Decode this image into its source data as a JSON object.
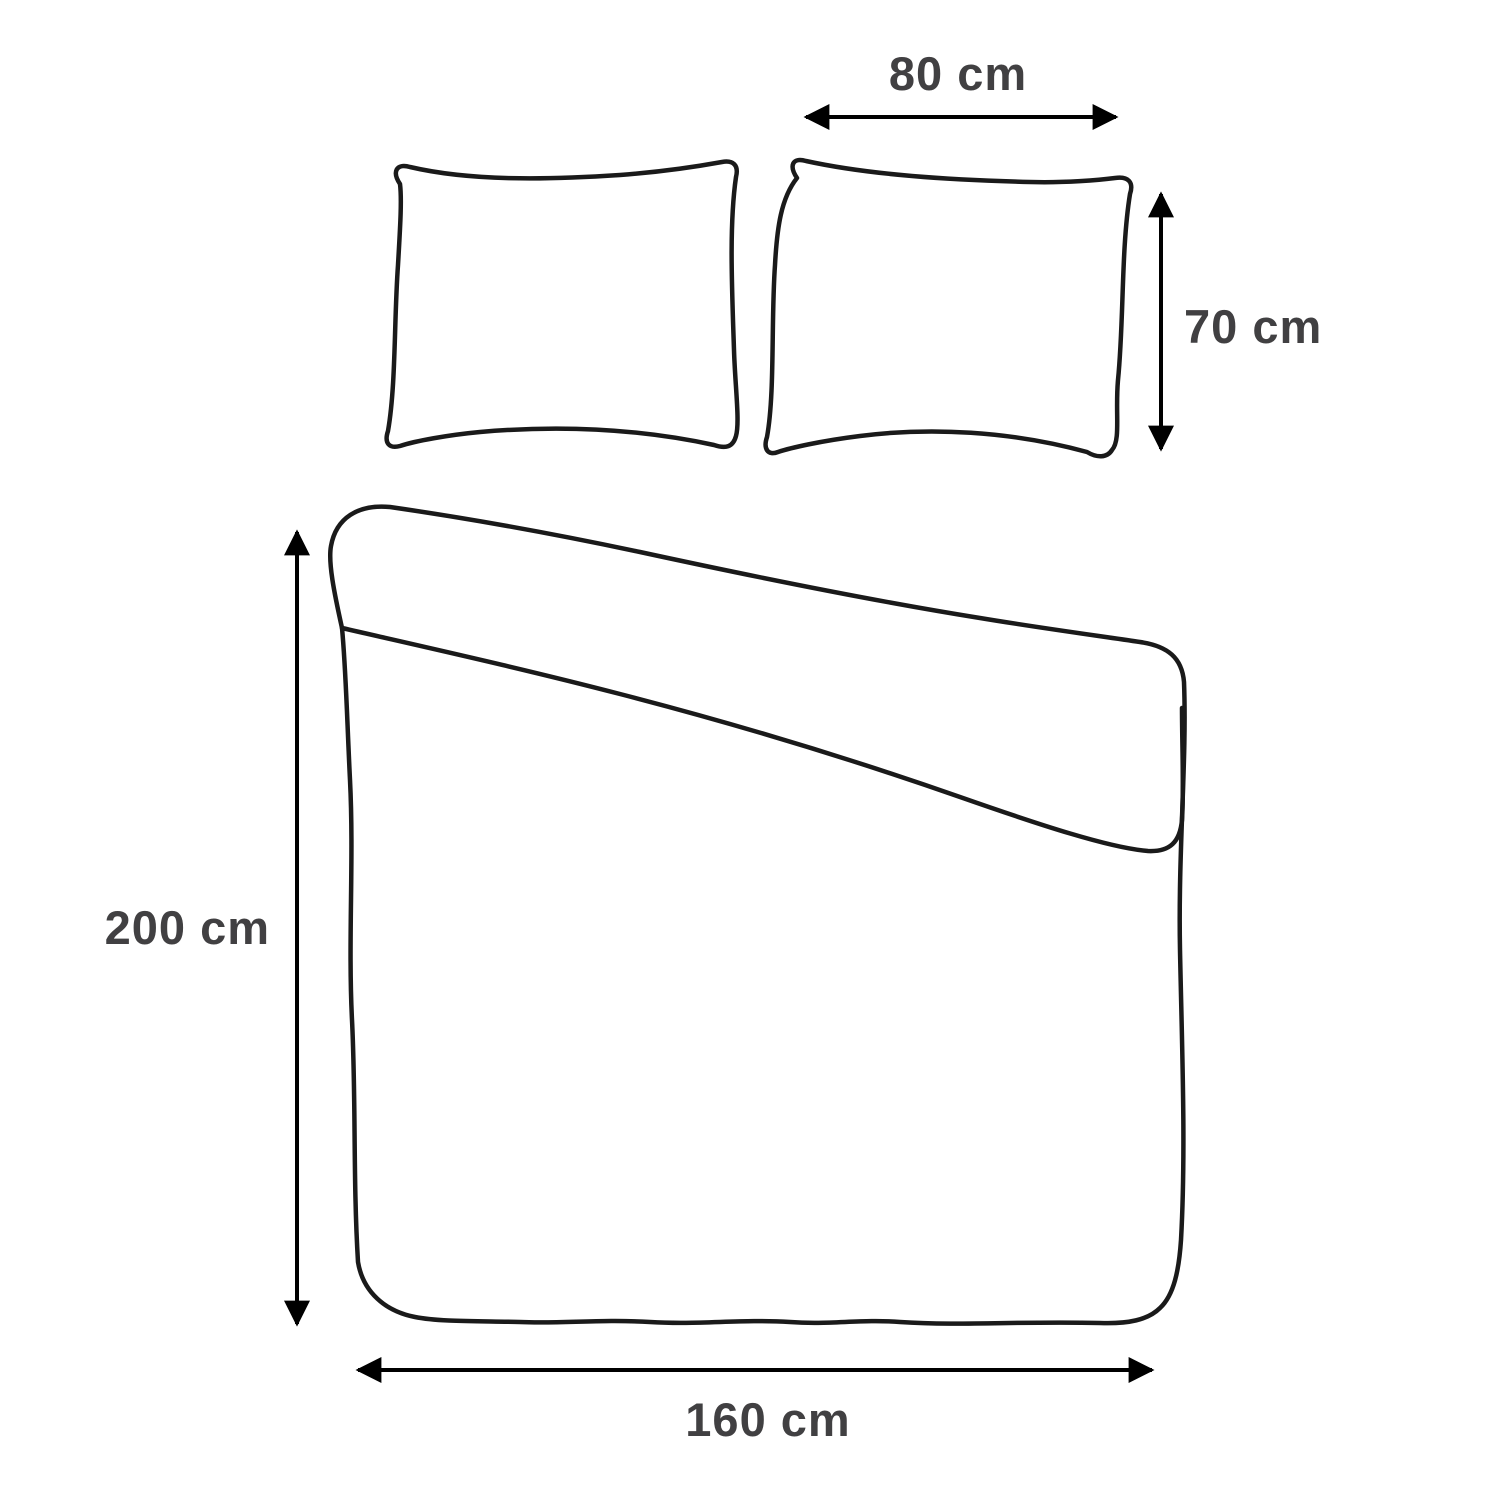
{
  "colors": {
    "background": "#ffffff",
    "line": "#1a1a1a",
    "arrow": "#000000",
    "label": "#414042"
  },
  "diagram": {
    "type": "product-dimension-diagram",
    "subject": "bedding set: two pillowcases and one duvet cover, line drawing with dimension arrows",
    "labels": {
      "pillow_width": "80 cm",
      "pillow_height": "70 cm",
      "duvet_height": "200 cm",
      "duvet_width": "160 cm"
    },
    "objects": [
      {
        "name": "pillowcase-left",
        "dimensions": "80 cm × 70 cm"
      },
      {
        "name": "pillowcase-right",
        "dimensions": "80 cm × 70 cm"
      },
      {
        "name": "duvet-cover",
        "dimensions": "160 cm × 200 cm"
      }
    ]
  }
}
